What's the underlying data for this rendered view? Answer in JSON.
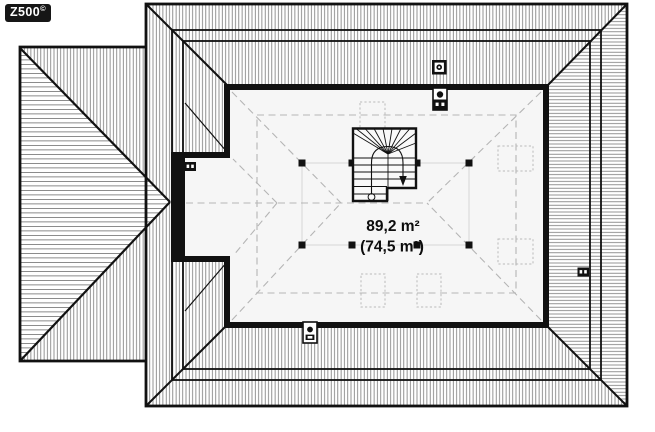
{
  "logo": {
    "text": "Z500",
    "copyright_mark": "©"
  },
  "floor_plan": {
    "type": "attic-roof-plan",
    "area_total": "89,2 m²",
    "area_usable": "(74,5 m²)",
    "symbols": {
      "chimney": "chimney-stack",
      "vent": "ventilation-stack",
      "skylights_count": 5,
      "columns_count": 8,
      "staircase": "winder-stair-with-down-arrow"
    },
    "colors": {
      "line": "#111111",
      "hatch": "#6e6e6e",
      "dashed_guides": "#b5b5b5",
      "knee_wall_lines": "#d2d2d2",
      "room_fill": "#f6f6f6",
      "logo_bg": "#161616",
      "logo_text": "#ffffff"
    }
  }
}
